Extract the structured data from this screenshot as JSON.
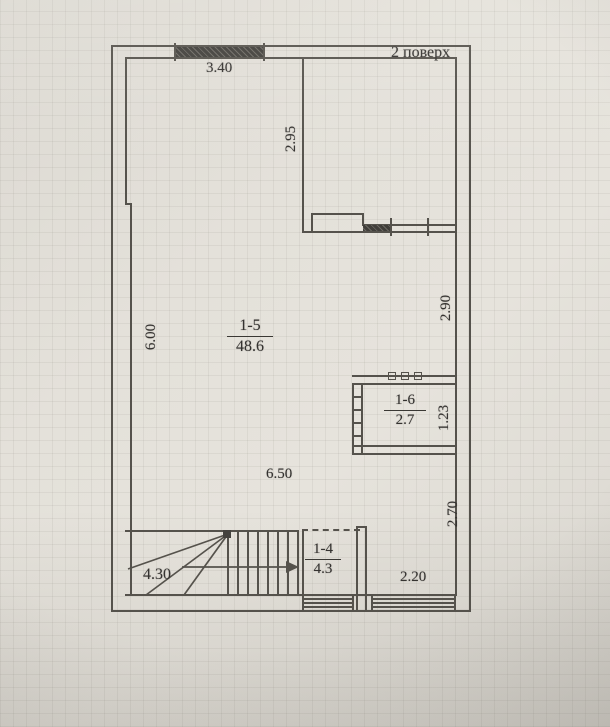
{
  "floor_plan": {
    "floor_label": "2 поверх",
    "rooms": [
      {
        "id": "1-5",
        "area": "48.6"
      },
      {
        "id": "1-6",
        "area": "2.7"
      },
      {
        "id": "1-4",
        "area": "4.3"
      }
    ],
    "dimensions": {
      "top_window_width": "3.40",
      "balcony_depth": "2.95",
      "left_wall_height": "6.00",
      "right_wall_upper": "2.90",
      "storage_height": "1.23",
      "main_room_width": "6.50",
      "right_wall_lower": "2.70",
      "stair_run": "4.30",
      "bottom_right_width": "2.20"
    },
    "colors": {
      "paper": "#e0ddd6",
      "line": "#55524c",
      "window_fill": "#403e3a",
      "text": "#343230"
    }
  }
}
